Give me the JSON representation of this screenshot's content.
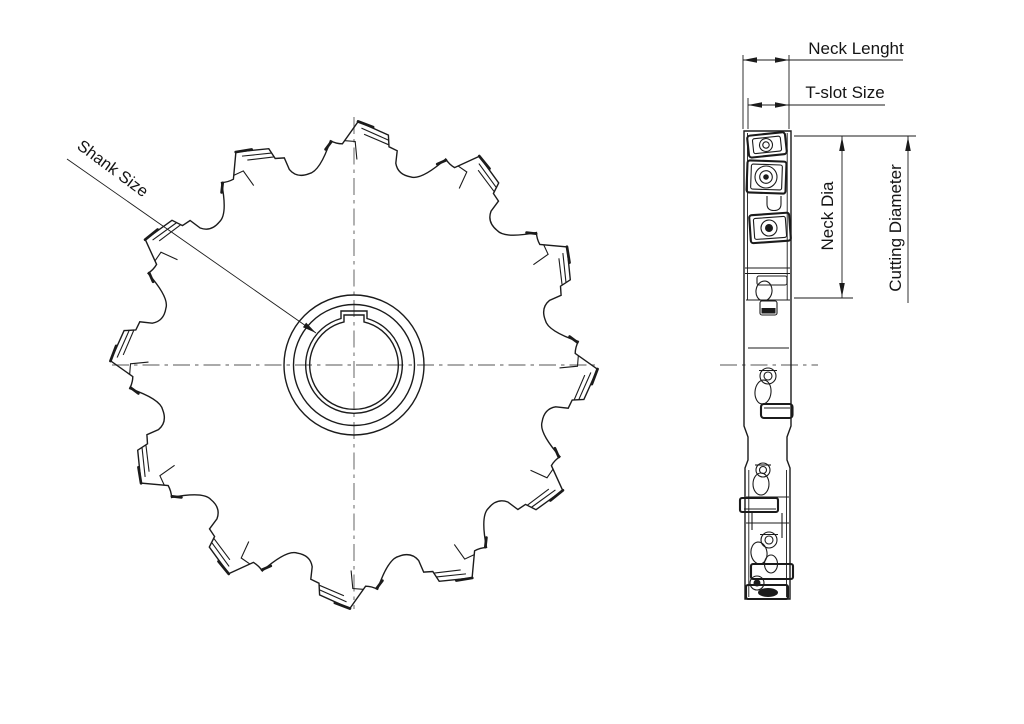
{
  "document": {
    "background": "#ffffff",
    "kind": "technical line drawing of a T-slot milling cutter (front view and side profile)"
  },
  "front_view": {
    "teeth_count": 12,
    "label_shank": "Shank Size"
  },
  "dimensions": {
    "shank_size": "Shank Size",
    "neck_length": "Neck Lenght",
    "tslot_size": "T-slot Size",
    "neck_dia": "Neck Dia",
    "cutting_diameter": "Cutting Diameter"
  },
  "colors": {
    "line": "#1b1b1b",
    "centerline": "#787878",
    "background": "#ffffff"
  }
}
